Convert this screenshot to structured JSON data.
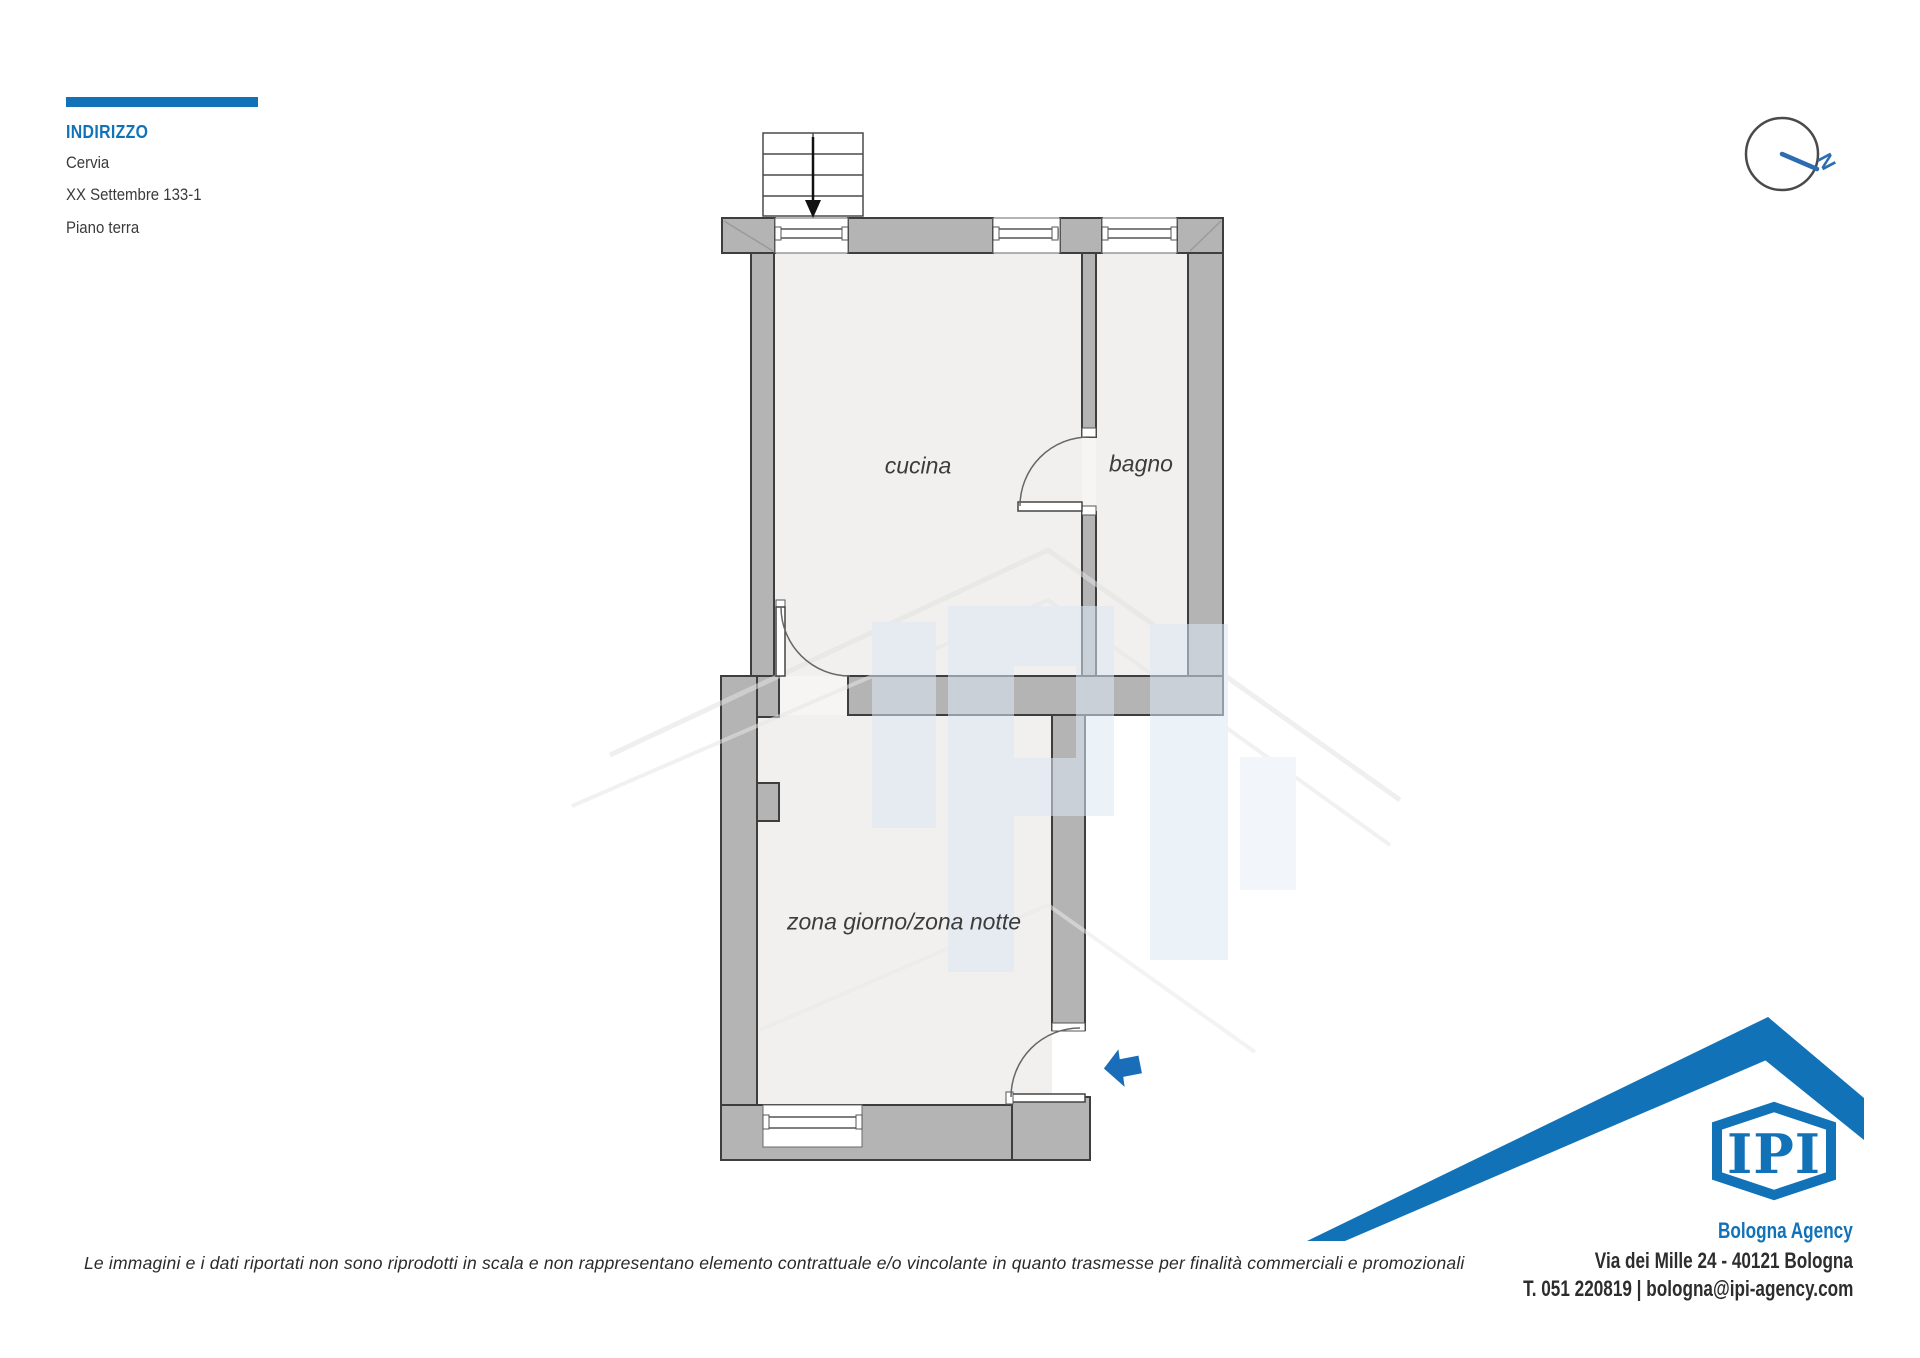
{
  "header": {
    "label": "INDIRIZZO",
    "city": "Cervia",
    "street": "XX Settembre 133-1",
    "floor": "Piano terra"
  },
  "compass": {
    "north": "N"
  },
  "plan": {
    "rooms": {
      "kitchen": "cucina",
      "bathroom": "bagno",
      "living": "zona giorno/zona notte"
    }
  },
  "branding": {
    "monogram": "IPI",
    "agency": "Bologna Agency",
    "address": "Via dei Mille 24 - 40121 Bologna",
    "contact": "T. 051 220819 | bologna@ipi-agency.com"
  },
  "disclaimer": "Le immagini e i dati riportati non sono riprodotti in scala e non rappresentano elemento contrattuale e/o vincolante in quanto trasmesse per finalità commerciali e promozionali",
  "colors": {
    "brand_blue": "#1272b8",
    "wall_gray": "#b4b4b4",
    "wall_outline": "#3e3e3e",
    "floor": "#f1f0ef",
    "text_dark": "#3a3a3a"
  }
}
